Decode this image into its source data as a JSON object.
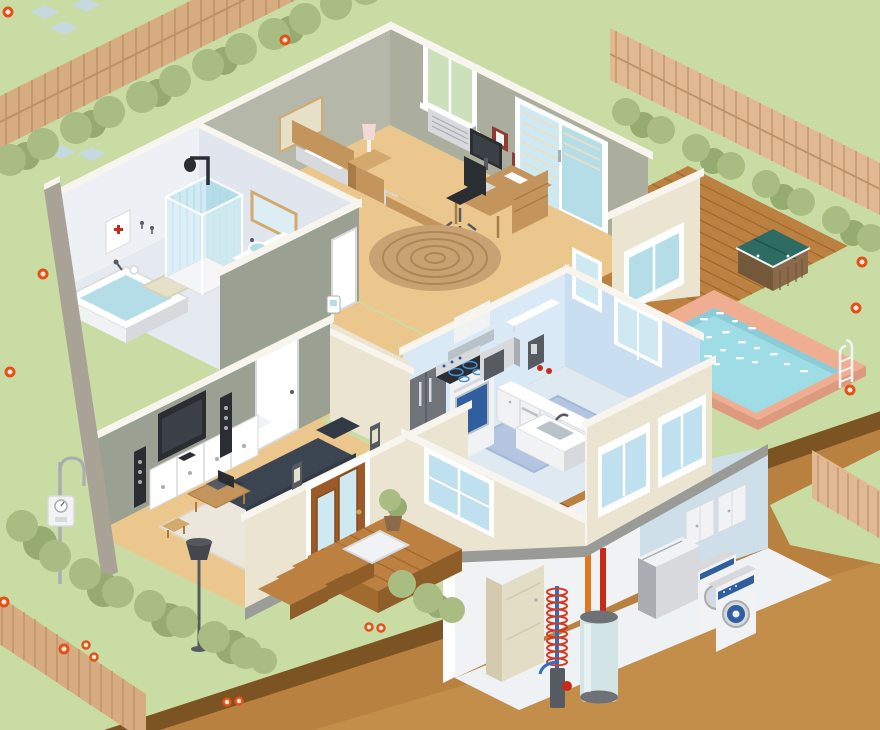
{
  "palette": {
    "grass": "#c9dca4",
    "hedge": "#a9bd82",
    "hedgeDark": "#96ab70",
    "fence": "#d6ac80",
    "fenceDark": "#bd9166",
    "fenceLight": "#e0b891",
    "stone": "#c5d9de",
    "flowerRing": "#e2511a",
    "flowerCenter": "#fde8cf",
    "earth": "#b9813f",
    "earthDark": "#7c5323",
    "earthLight": "#cf9d58",
    "deck": "#bc8040",
    "deckLine": "#a16a2f",
    "deckEdge": "#8f5e28",
    "coping": "#efae92",
    "copingDark": "#dd9a7e",
    "water": "#9edce6",
    "waterDark": "#8bccd8",
    "sparkle": "#ffffff",
    "tealCover": "#2d6b63",
    "tealCoverDark": "#1f544d",
    "tubWood": "#8a6a4a",
    "tubWoodDark": "#74583a",
    "cream": "#eae4d0",
    "taupe": "#a8a396",
    "foundation": "#9c9c99",
    "slab": "#9a9a97",
    "wallTop": "#f7f5ee",
    "greenWall": "#b5b7a8",
    "greenWall2": "#abae9d",
    "greenWallDark": "#9aa092",
    "bathWall": "#edf0f5",
    "bathWallShade": "#e1e6ee",
    "bathFloor": "#e4eaf0",
    "carpet": "#ecc78d",
    "rug": "#ebe7dc",
    "kitchenWall": "#d9eaf6",
    "kitchenWallDark": "#c9def0",
    "kitchenFloor": "#dfe9f1",
    "kitchenRug": "#b4c5e1",
    "rugBlueDark": "#a3b8d6",
    "basementWall": "#cfdfe9",
    "basementWallDark": "#bdd2df",
    "basementFloor": "#eef2f5",
    "wood": "#c3955c",
    "woodDark": "#a87c44",
    "woodLight": "#d4a96e",
    "white": "#ffffff",
    "offWhite": "#f1f2f4",
    "grayLight": "#d7d9dc",
    "gray": "#a9adb2",
    "graySteel": "#6e747a",
    "grayDark": "#565b61",
    "black": "#2a2d31",
    "screenDark": "#3c4148",
    "navy": "#3c4652",
    "navyDark": "#313a45",
    "accentBlue": "#2f5f9e",
    "glass": "#cfe9f3",
    "glassBlue": "#bfe0ee",
    "glassDeep": "#b5dde8",
    "windowGreen": "#cde0bc",
    "doorWood": "#9c5a28",
    "doorWoodDark": "#854b1f",
    "furnace": "#e4ddc6",
    "furnaceShade": "#d3cab0",
    "heater": "#d3e4e6",
    "heaterCap": "#6e7276",
    "pipeOrange": "#e0761f",
    "pipeRed": "#c92918",
    "coilRed": "#d43a1e",
    "coilBlue": "#2f6fc1",
    "mirror": "#dcedf4",
    "frameRed": "#8e3b32",
    "mat": "#e6e0c8",
    "towelY": "#e8d44f",
    "towelB": "#66b5e7",
    "towelP": "#e87ab0",
    "lampShade": "#43474d",
    "lampPink": "#f3d9d6",
    "steel": "#b9c2c8",
    "tile": "#a9d9e2",
    "rugTan": "#c9a273",
    "rugTanDark": "#b08655",
    "burnerBlue": "#4a90d9",
    "brass": "#caa54c"
  },
  "scene": {
    "type": "isometric-home-cutaway",
    "yard": {
      "items": [
        "lawn",
        "picket-fence-top-left",
        "picket-fence-right",
        "picket-fence-bottom-left",
        "picket-fence-bottom-right",
        "hedges",
        "stepping-stones",
        "flowers"
      ]
    },
    "outdoor": {
      "items": [
        "wood-deck",
        "swimming-pool",
        "pool-ladder",
        "hot-tub",
        "porch",
        "front-steps",
        "door-mat",
        "potted-plant",
        "electric-meter",
        "foundation",
        "earth-cutaway"
      ]
    },
    "rooms": {
      "bathroom": {
        "items": [
          "bathtub",
          "shower-stall",
          "shower-head",
          "vanity-two-sinks",
          "mirror",
          "medicine-cabinet",
          "bath-mat",
          "towels",
          "toilet-paper-holder",
          "towel-hooks"
        ]
      },
      "bedroom_office": {
        "items": [
          "bed",
          "pillows",
          "blanket",
          "nightstand",
          "table-lamp",
          "wall-art",
          "window-with-ac-unit",
          "sliding-glass-door",
          "picture-frames",
          "desk",
          "computer-monitor",
          "keyboard",
          "office-chair",
          "round-rug"
        ]
      },
      "hallway": {
        "items": [
          "thermostat",
          "interior-door",
          "bathroom-door"
        ]
      },
      "living_room": {
        "items": [
          "flat-screen-tv",
          "media-console",
          "tower-speakers",
          "sofa",
          "coffee-table",
          "laptop",
          "side-stool",
          "floor-lamp",
          "area-rug",
          "front-door",
          "wall-sconces"
        ]
      },
      "kitchen": {
        "items": [
          "refrigerator",
          "range-oven",
          "cooktop",
          "range-hood",
          "microwave",
          "dishwasher",
          "drawer-cabinets",
          "corner-cabinet",
          "sink-island",
          "coffee-maker",
          "wall-shelf",
          "tomatoes",
          "windows",
          "area-rug"
        ]
      },
      "basement": {
        "items": [
          "furnace",
          "geothermal-loop",
          "water-heater",
          "hot-water-pipe",
          "cold-water-pipe",
          "shutoff-valve"
        ]
      },
      "laundry_room": {
        "items": [
          "storage-cabinets",
          "chest-freezer",
          "dryer",
          "washing-machine"
        ]
      }
    }
  }
}
